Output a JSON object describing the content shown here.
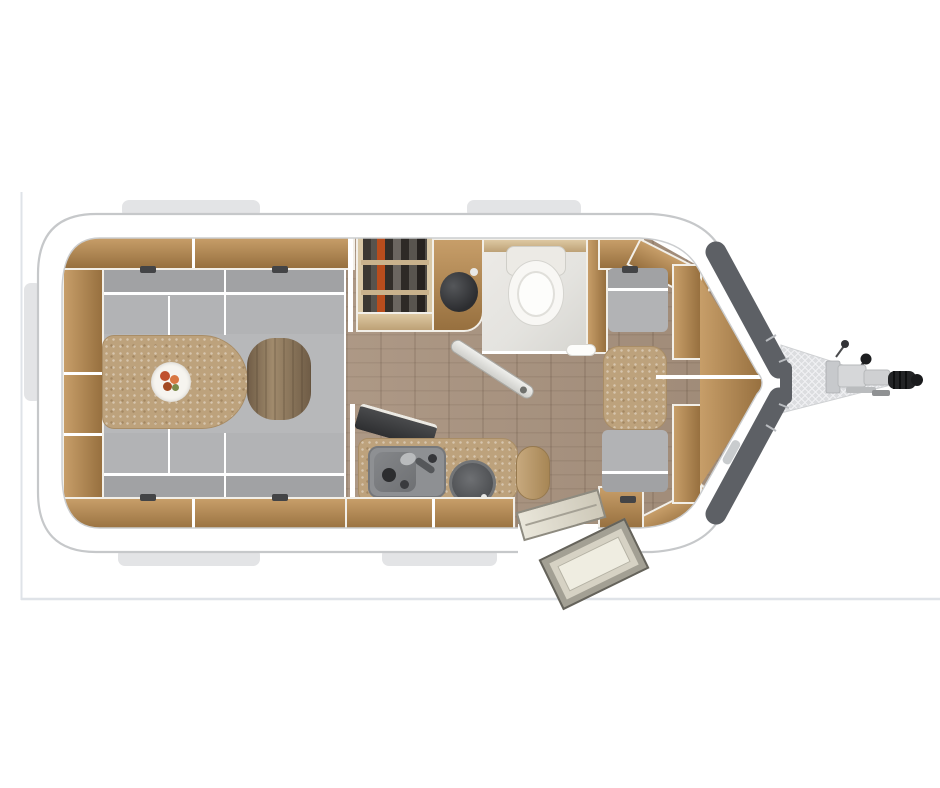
{
  "meta": {
    "description": "Top-down 3D floor plan of a single-axle travel trailer caravan, hitch pointing right: rear U-shaped lounge with oval table, wardrobe with hanging clothes, corner washroom with basin and toilet, kitchen block with sink and round hob, front dinette with table and bench seats, entry door with step, and A-frame drawbar with coupling.",
    "visible_text": []
  },
  "colors": {
    "page-bg": "#ffffff",
    "frame-line": "#dfe3e8",
    "tab-gray": "#e3e4e6",
    "body-fill": "#ffffff",
    "body-outline": "#c6c8ca",
    "inner-line": "#cbcdcf",
    "nose-dark": "#5d6065",
    "nose-seam": "#b9bcc0",
    "hatch-bg": "#dcdde0",
    "hatch-line": "#f2f3f5",
    "metal-light": "#d6d7d9",
    "metal-mid": "#b7b9bb",
    "black-part": "#232426",
    "wood-hi": "#c79e69",
    "wood-lo": "#97703f",
    "wood-edge": "#f2efe8",
    "wood-light-hi": "#ddc8a2",
    "wood-light-lo": "#bda176",
    "floor-base": "#a8927e",
    "seat": "#b2b3b5",
    "seat-mid": "#b7b8ba",
    "seat-dark": "#a1a2a4",
    "seam-white": "#ffffff",
    "tan-speckle": "#bda27c",
    "tan-speckle-edge": "#a98d66",
    "bath-floor": "#e4e3df",
    "porcelain": "#f8f7f4",
    "basin-dark": "#2c2d30",
    "appliance": "#8e9093",
    "hob-dark": "#4a4c4f",
    "accent-orange": "#b84d1d",
    "wardrobe-dark": "#2a2622",
    "bolster-hi": "#a08a6c",
    "bolster-lo": "#6f5c46",
    "step-light": "#efede1",
    "step-mid": "#d6d2c4",
    "step-dark": "#a3a094",
    "step-edge": "#65635b"
  },
  "floorplan": {
    "view": "top-down",
    "orientation": "hitch-right",
    "zones": [
      {
        "name": "rear-u-lounge",
        "items": [
          "u-shaped-sofa",
          "oval-table",
          "serving-plate",
          "bolster-cushion",
          "side-shelves",
          "overhead-lockers"
        ]
      },
      {
        "name": "wardrobe",
        "items": [
          "hanging-clothes",
          "shelf"
        ]
      },
      {
        "name": "washroom",
        "items": [
          "corner-washbasin",
          "toilet",
          "pivot-door"
        ]
      },
      {
        "name": "kitchen",
        "items": [
          "worktop",
          "sink",
          "round-hob",
          "worktop-end-cap",
          "flip-up-extension"
        ]
      },
      {
        "name": "front-dinette",
        "items": [
          "table",
          "bench-seat-front",
          "bench-seat-rear",
          "v-shelves"
        ]
      },
      {
        "name": "entry",
        "items": [
          "door-opening",
          "inner-step",
          "outer-step"
        ]
      },
      {
        "name": "a-frame-drawbar",
        "items": [
          "hatched-chassis",
          "jockey-crank",
          "handbrake-knob",
          "coupling-head"
        ]
      }
    ]
  }
}
